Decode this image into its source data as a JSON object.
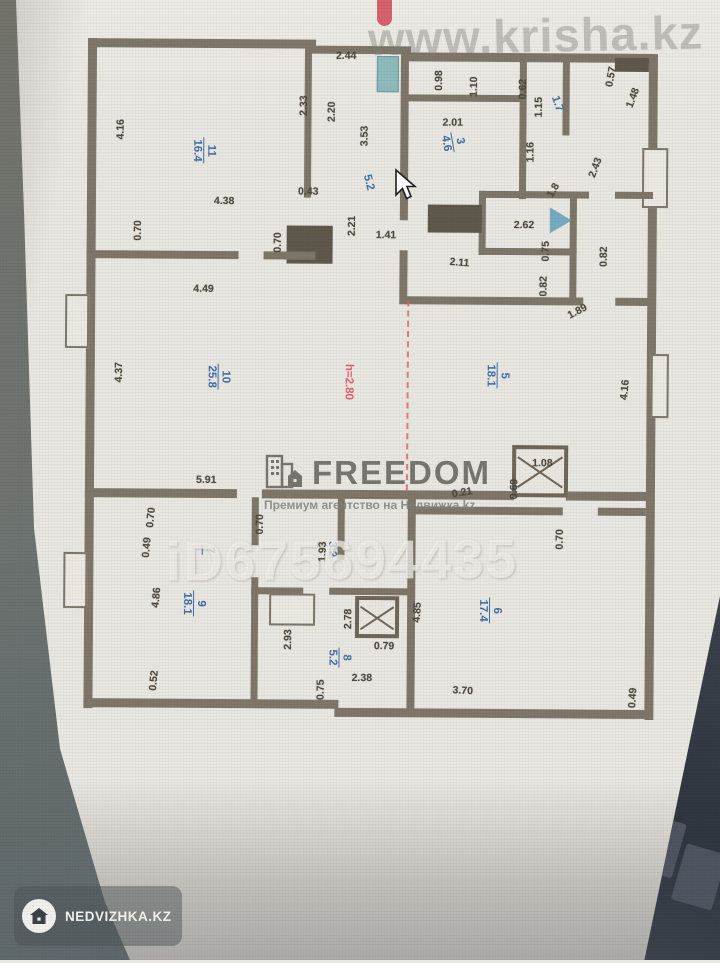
{
  "watermarks": {
    "krisha": "www.krisha.kz",
    "freedom_name": "FREEDOM",
    "freedom_tagline": "Премиум агентство на Недвижка.kz",
    "listing_id": "iD675694435",
    "badge_label": "NEDVIZHKA.KZ"
  },
  "icons": {
    "freedom_logo": "building-house-icon",
    "badge": "house-icon",
    "cursor": "mouse-cursor-arrow"
  },
  "colors": {
    "wall": "#7e7769",
    "room_label_blue": "#3f6fa6",
    "height_label_red": "#e0606b",
    "paper": "#e9e7e1"
  },
  "plan": {
    "ceiling_height": "h=2.80",
    "rooms": [
      {
        "number": "11",
        "area": "16.4"
      },
      {
        "number": "3",
        "area": "4.6"
      },
      {
        "number": "",
        "area": "1.7"
      },
      {
        "number": "10",
        "area": "25.8"
      },
      {
        "number": "5",
        "area": "18.1"
      },
      {
        "number": "9",
        "area": "18.1"
      },
      {
        "number": "8",
        "area": "5.2"
      },
      {
        "number": "6",
        "area": "17.4"
      },
      {
        "number": "7",
        "area": ""
      },
      {
        "number": "",
        "area": "5.2"
      },
      {
        "number": "",
        "area": "3.2"
      }
    ],
    "dimensions": [
      "2.44",
      "2.33",
      "2.20",
      "4.16",
      "0.43",
      "4.38",
      "0.70",
      "0.70",
      "4.49",
      "3.53",
      "2.21",
      "1.41",
      "0.98",
      "1.10",
      "2.01",
      "0.62",
      "1.15",
      "1.16",
      "0.57",
      "1.48",
      "2.43",
      "1.8",
      "2.62",
      "2.11",
      "0.75",
      "0.82",
      "0.82",
      "1.89",
      "4.37",
      "5.91",
      "4.16",
      "1.08",
      "0.69",
      "0.21",
      "0.70",
      "0.70",
      "0.49",
      "4.86",
      "0.52",
      "0.70",
      "1.93",
      "2.93",
      "2.78",
      "0.79",
      "2.38",
      "0.75",
      "4.85",
      "3.70",
      "0.49"
    ]
  }
}
